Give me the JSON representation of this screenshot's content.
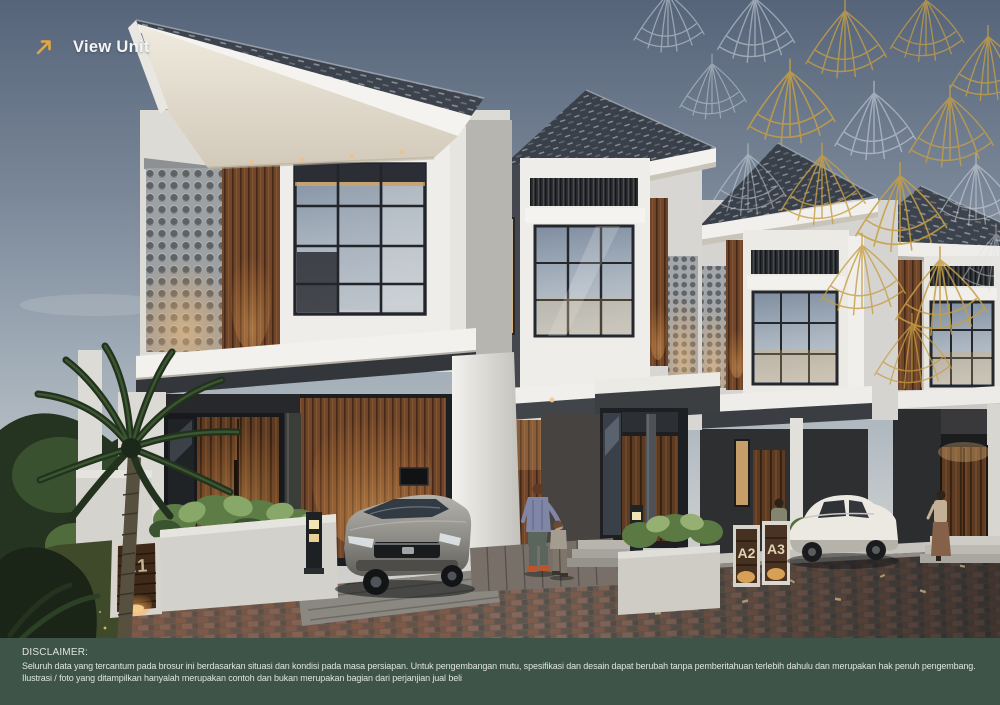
{
  "view_unit_button": {
    "label": "View Unit",
    "icon": "arrow-up-right-icon"
  },
  "unit_signs": {
    "a1": "A1",
    "a2": "A2",
    "a3": "A3"
  },
  "disclaimer": {
    "heading": "DISCLAIMER:",
    "lines": [
      "Seluruh data yang tercantum pada brosur ini berdasarkan situasi dan kondisi pada masa persiapan. Untuk pengembangan mutu, spesifikasi dan desain dapat berubah tanpa pemberitahuan terlebih dahulu dan merupakan  hak penuh pengembang.",
      "Ilustrasi / foto yang ditampilkan hanyalah merupakan contoh dan bukan merupakan bagian dari perjanjian jual beli"
    ]
  },
  "colors": {
    "accent_gold": "#E2A63D",
    "fan_gold": "#C69F45",
    "fan_silver": "#DCE1E6",
    "band_green": "#3E5449",
    "disclaimer_text": "#DEE4DD",
    "view_unit_text": "#F4F5F3"
  }
}
